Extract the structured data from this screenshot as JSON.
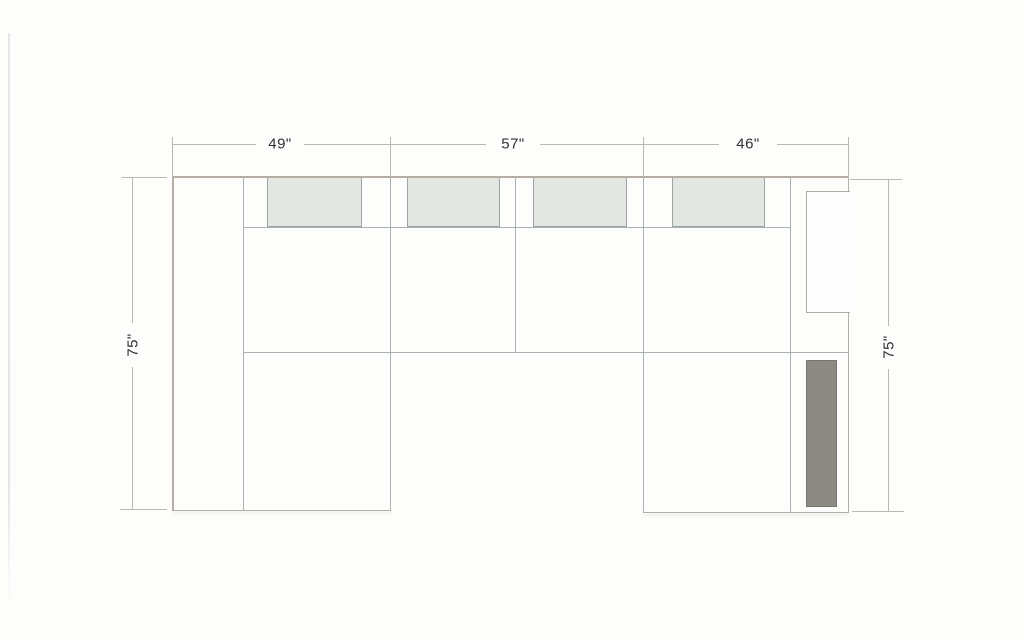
{
  "diagram": {
    "kind": "sectional-sofa-floorplan-top-view",
    "dimensions": {
      "top_segments": [
        {
          "label": "49\""
        },
        {
          "label": "57\""
        },
        {
          "label": "46\""
        }
      ],
      "left": {
        "label": "75\""
      },
      "right": {
        "label": "75\""
      }
    },
    "colors": {
      "background": "#fdfdfb",
      "outline_line": "#b5aea4",
      "interior_line": "#a9b2b6",
      "dimension_line": "#bdb7ae",
      "label_text": "#2c3036",
      "cushion_fill": "#e4e6e1",
      "cushion_border": "#9ca5a5",
      "right_back_cushion_fill": "#fefefe",
      "dark_pad_fill": "#8d8983"
    }
  }
}
